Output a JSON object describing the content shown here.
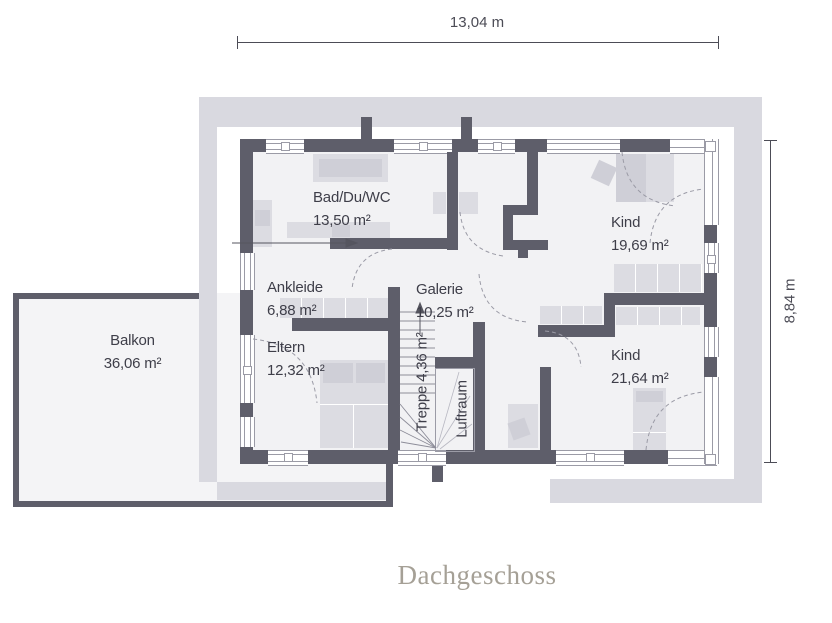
{
  "title": "Dachgeschoss",
  "dimensions": {
    "width": "13,04 m",
    "height": "8,84 m"
  },
  "rooms": {
    "bad": {
      "name": "Bad/Du/WC",
      "area": "13,50 m²"
    },
    "ankleide": {
      "name": "Ankleide",
      "area": "6,88 m²"
    },
    "galerie": {
      "name": "Galerie",
      "area": "10,25 m²"
    },
    "eltern": {
      "name": "Eltern",
      "area": "12,32 m²"
    },
    "kind_nord": {
      "name": "Kind",
      "area": "19,69 m²"
    },
    "kind_sued": {
      "name": "Kind",
      "area": "21,64 m²"
    },
    "balkon": {
      "name": "Balkon",
      "area": "36,06 m²"
    },
    "treppe": {
      "label": "Treppe 4,36 m²"
    },
    "luftraum": {
      "label": "Luftraum"
    }
  },
  "colors": {
    "wall": "#5e5e6a",
    "band": "#d9d9e0",
    "floor": "#f2f2f4",
    "floorBalcony": "#f4f4f6",
    "furniture": "#dcdce2",
    "furnitureDark": "#cfcfd7",
    "windowLine": "#9b9ba6",
    "dimension": "#4c4c56",
    "label": "#3e3e49",
    "title": "#a5a096",
    "arc": "#9b9ba6",
    "tread": "#8d8d99"
  }
}
